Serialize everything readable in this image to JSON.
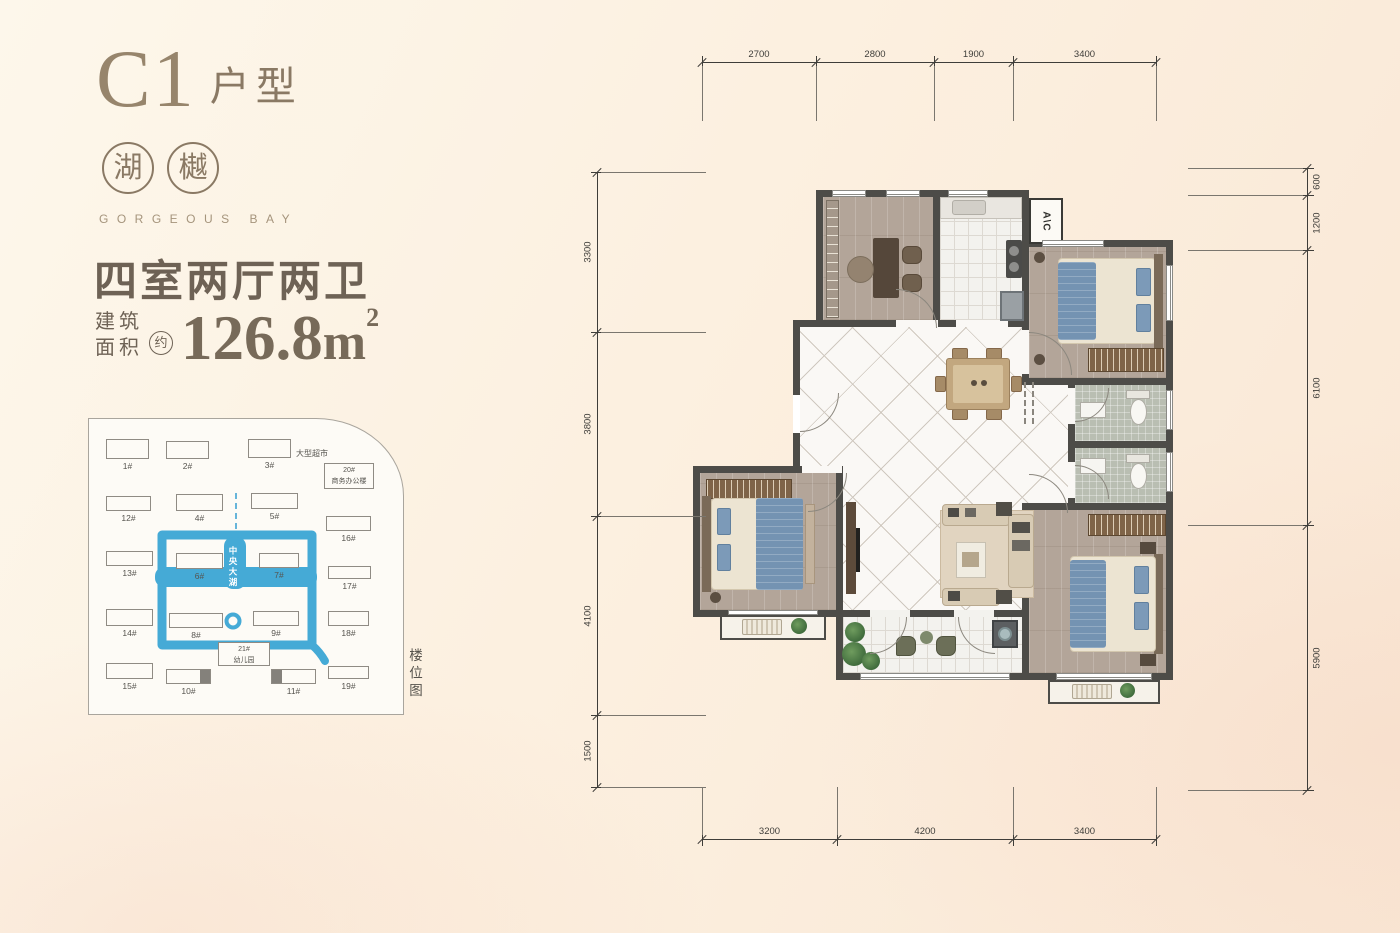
{
  "colors": {
    "wall": "#4d4c48",
    "lake": "#45aad6",
    "brand": "#8a7964",
    "text": "#6e6255",
    "bed_blue": "#7493b2"
  },
  "header": {
    "unit": "C1",
    "unit_type": "户型",
    "brand_chars": [
      "湖",
      "樾"
    ],
    "brand_en": "GORGEOUS BAY"
  },
  "specs": {
    "layout": "四室两厅两卫",
    "area_prefix_l1": "建筑",
    "area_prefix_l2": "面积",
    "approx": "约",
    "area": "126.8",
    "unit": "m",
    "exp": "2"
  },
  "floorplan": {
    "ac": "A\\C"
  },
  "sitemap": {
    "side_label": "楼位图",
    "lake_label": "中央大湖",
    "supermarket_label": "大型超市",
    "buildings": [
      {
        "label": "1#",
        "x": 17,
        "y": 20,
        "w": 43,
        "h": 20
      },
      {
        "label": "2#",
        "x": 77,
        "y": 22,
        "w": 43,
        "h": 18
      },
      {
        "label": "3#",
        "x": 159,
        "y": 20,
        "w": 43,
        "h": 19
      },
      {
        "lines": [
          "20#",
          "商务办公楼"
        ],
        "x": 235,
        "y": 44,
        "w": 50,
        "h": 26
      },
      {
        "label": "12#",
        "x": 17,
        "y": 77,
        "w": 45,
        "h": 15
      },
      {
        "label": "4#",
        "x": 87,
        "y": 75,
        "w": 47,
        "h": 17
      },
      {
        "label": "5#",
        "x": 162,
        "y": 74,
        "w": 47,
        "h": 16
      },
      {
        "label": "16#",
        "x": 237,
        "y": 97,
        "w": 45,
        "h": 15
      },
      {
        "label": "13#",
        "x": 17,
        "y": 132,
        "w": 47,
        "h": 15
      },
      {
        "label": "6#",
        "x": 87,
        "y": 134,
        "w": 47,
        "h": 16
      },
      {
        "label": "7#",
        "x": 170,
        "y": 134,
        "w": 40,
        "h": 15
      },
      {
        "label": "17#",
        "x": 239,
        "y": 147,
        "w": 43,
        "h": 13
      },
      {
        "label": "14#",
        "x": 17,
        "y": 190,
        "w": 47,
        "h": 17
      },
      {
        "label": "8#",
        "x": 80,
        "y": 194,
        "w": 54,
        "h": 15
      },
      {
        "label": "9#",
        "x": 164,
        "y": 192,
        "w": 46,
        "h": 15
      },
      {
        "label": "18#",
        "x": 239,
        "y": 192,
        "w": 41,
        "h": 15
      },
      {
        "lines": [
          "21#",
          "幼儿园"
        ],
        "x": 129,
        "y": 223,
        "w": 52,
        "h": 24
      },
      {
        "label": "15#",
        "x": 17,
        "y": 244,
        "w": 47,
        "h": 16
      },
      {
        "label": "10#",
        "x": 77,
        "y": 250,
        "w": 45,
        "h": 15,
        "dark": "r"
      },
      {
        "label": "11#",
        "x": 182,
        "y": 250,
        "w": 45,
        "h": 15,
        "dark": "l"
      },
      {
        "label": "19#",
        "x": 239,
        "y": 247,
        "w": 41,
        "h": 13
      }
    ]
  },
  "dimensions": {
    "top": {
      "values": [
        "2700",
        "2800",
        "1900",
        "3400"
      ],
      "px": [
        114,
        118,
        79,
        143
      ]
    },
    "bottom": {
      "values": [
        "3200",
        "4200",
        "3400"
      ],
      "px": [
        135,
        176,
        143
      ]
    },
    "left": {
      "values": [
        "3300",
        "3800",
        "4100",
        "1500"
      ],
      "px": [
        160,
        184,
        199,
        72
      ]
    },
    "right": {
      "values": [
        "600",
        "1200",
        "6100",
        "5900"
      ],
      "px": [
        27,
        55,
        275,
        265
      ]
    }
  }
}
